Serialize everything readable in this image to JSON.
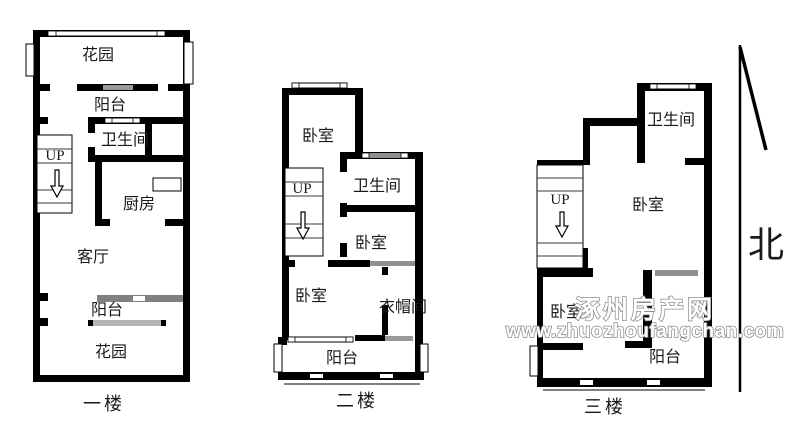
{
  "floor1": {
    "name": "一楼",
    "garden_top": "花园",
    "balcony_top": "阳台",
    "bathroom": "卫生间",
    "stairs_up": "UP",
    "kitchen": "厨房",
    "living_room": "客厅",
    "balcony_bottom": "阳台",
    "garden_bottom": "花园"
  },
  "floor2": {
    "name": "二楼",
    "bedroom_top": "卧室",
    "bathroom": "卫生间",
    "stairs_up": "UP",
    "bedroom_mid": "卧室",
    "bedroom_bottom": "卧室",
    "cloakroom": "衣帽间",
    "balcony": "阳台"
  },
  "floor3": {
    "name": "三楼",
    "bathroom": "卫生间",
    "stairs_up": "UP",
    "bedroom_main": "卧室",
    "bedroom_small": "卧室",
    "balcony": "阳台"
  },
  "compass": {
    "north": "北"
  },
  "watermark": {
    "site_name": "涿州房产网",
    "site_url": "www.zhuozhoufangchan.com"
  },
  "colors": {
    "wall": "#000000",
    "window_bar_dark": "#808080",
    "window_bar_light": "#b3b3b3",
    "watermark_outline": "#8c8c8c"
  }
}
